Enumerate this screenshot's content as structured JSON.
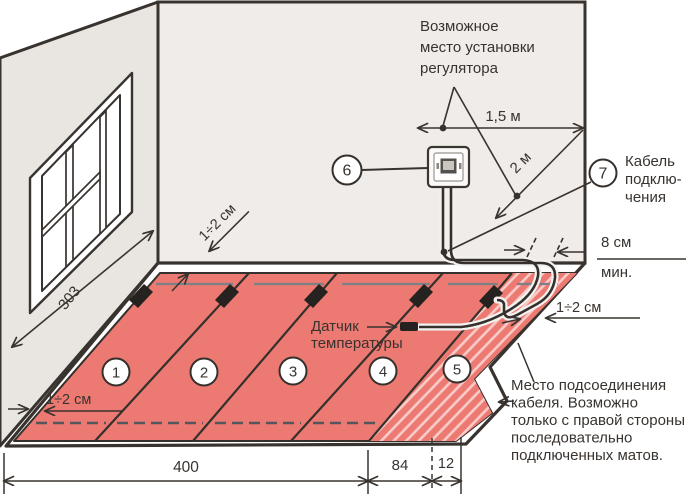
{
  "labels": {
    "regulator_note": [
      "Возможное",
      "место установки",
      "регулятора"
    ],
    "dim_15m": "1,5 м",
    "dim_2m": "2 м",
    "cable_connection": [
      "Кабель",
      "подклю-",
      "чения"
    ],
    "min_8cm": [
      "8 см",
      "мин."
    ],
    "gap_right": "1÷2 см",
    "gap_top": "1÷2 см",
    "gap_left": "1÷2 см",
    "wall_length": "303",
    "sensor": [
      "Датчик",
      "температуры"
    ],
    "connection_place": [
      "Место подсоединения",
      "кабеля. Возможно",
      "только с правой стороны",
      "последовательно",
      "подключенных матов."
    ],
    "dim_400": "400",
    "dim_84": "84",
    "dim_12": "12"
  },
  "markers": {
    "mat1": "1",
    "mat2": "2",
    "mat3": "3",
    "mat4": "4",
    "mat5": "5",
    "thermostat": "6",
    "cable": "7"
  },
  "colors": {
    "mat_red": "#ed7a72",
    "wall": "#efecea",
    "wall_left": "#e9e6e2",
    "line": "#38332f",
    "gray_cable": "#7d8084",
    "dash_cable": "#53565a"
  }
}
